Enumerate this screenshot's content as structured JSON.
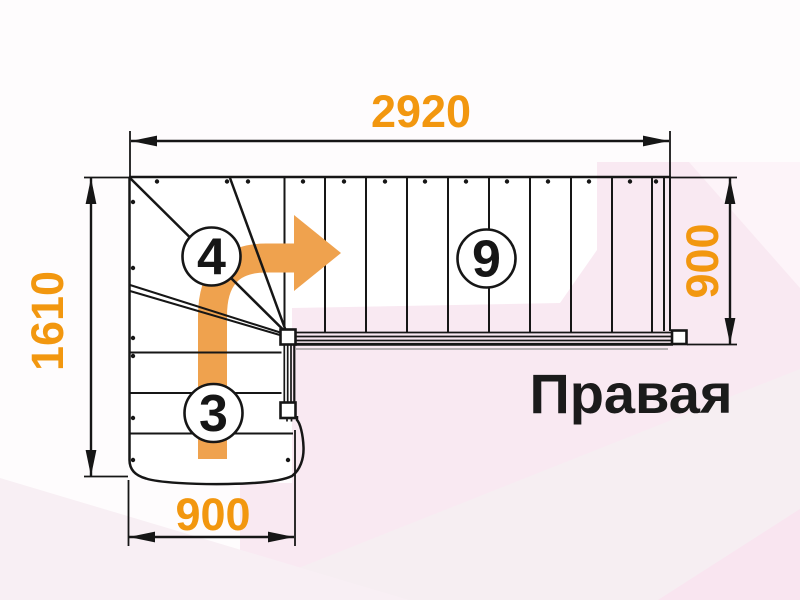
{
  "label": {
    "text": "Правая"
  },
  "dimensions": {
    "top": "2920",
    "left": "1610",
    "right": "900",
    "bottom": "900"
  },
  "steps": {
    "winder": "4",
    "main_flight": "9",
    "lower_flight": "3"
  },
  "colors": {
    "dimension_text": "#F2970F",
    "arrow": "#EFA24E",
    "line": "#161616",
    "label_text": "#1b1b1b"
  },
  "icons": {
    "direction_arrow": "turn-right-arrow"
  }
}
